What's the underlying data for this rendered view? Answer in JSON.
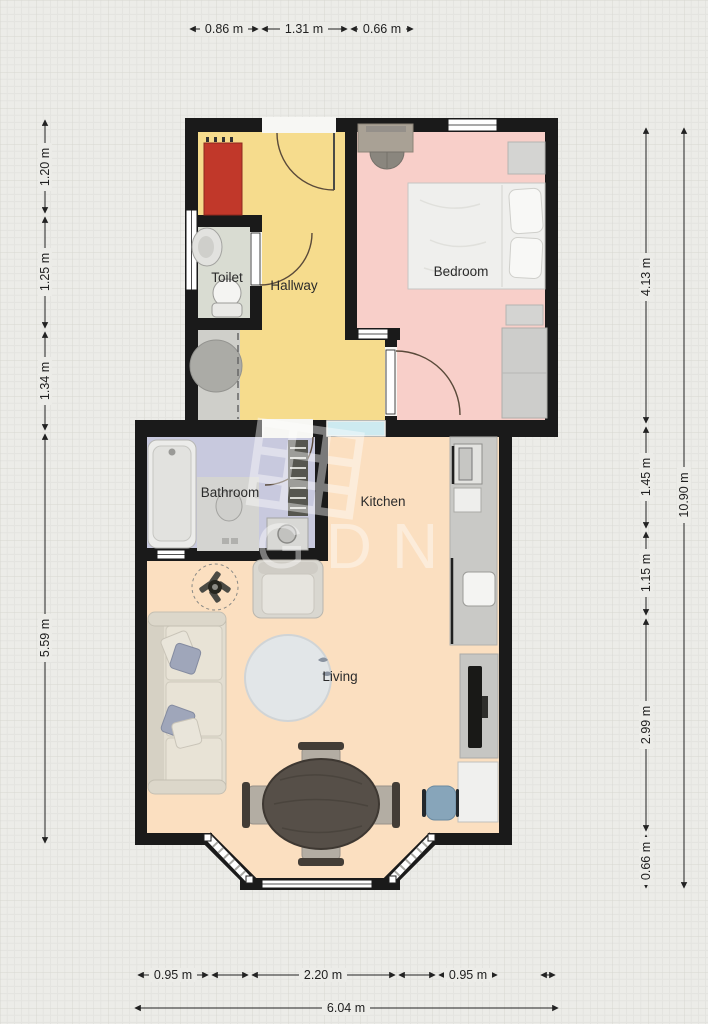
{
  "watermark": {
    "text": "GDN"
  },
  "rooms": {
    "toilet": "Toilet",
    "hallway": "Hallway",
    "bedroom": "Bedroom",
    "bathroom": "Bathroom",
    "kitchen": "Kitchen",
    "living": "Living"
  },
  "dimensions": {
    "top": [
      "0.86 m",
      "1.31 m",
      "0.66 m"
    ],
    "left": [
      "1.20 m",
      "1.25 m",
      "1.34 m",
      "5.59 m"
    ],
    "right": [
      "4.13 m",
      "1.45 m",
      "1.15 m",
      "2.99 m",
      "0.66 m"
    ],
    "right_total": "10.90 m",
    "bottom": [
      "0.95 m",
      "2.20 m",
      "0.95 m"
    ],
    "bottom_total": "6.04 m"
  },
  "colors": {
    "background": "#ecece8",
    "wall": "#1a1a1a",
    "hallway": "#f6dc8d",
    "bedroom": "#f8cfc9",
    "toilet_room": "#d9dcd2",
    "storage": "#cfcfca",
    "bathroom": "#c8c9de",
    "living": "#fbdfc0",
    "glass": "#cdeaf0",
    "red_cabinet": "#c1382a",
    "dim_line": "#222222",
    "watermark_white": "#ffffff"
  }
}
